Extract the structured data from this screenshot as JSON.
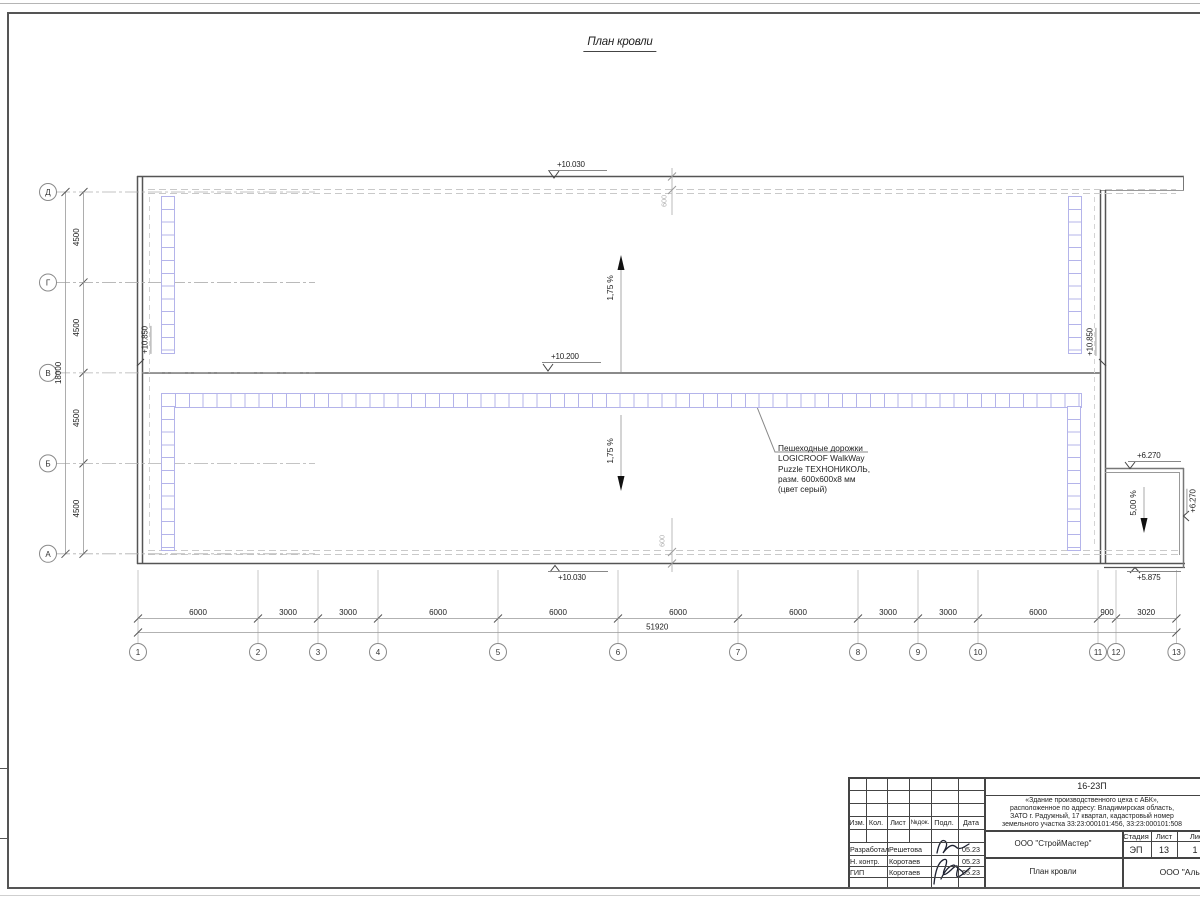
{
  "sheet": {
    "title": "План кровли"
  },
  "grid": {
    "cols": [
      "1",
      "2",
      "3",
      "4",
      "5",
      "6",
      "7",
      "8",
      "9",
      "10",
      "11",
      "12",
      "13"
    ],
    "col_spans": [
      "6000",
      "3000",
      "3000",
      "6000",
      "6000",
      "6000",
      "6000",
      "3000",
      "3000",
      "6000",
      "900",
      "3020"
    ],
    "col_total": "51920",
    "rows": [
      "Д",
      "Г",
      "В",
      "Б",
      "А"
    ],
    "row_spans": [
      "4500",
      "4500",
      "4500",
      "4500"
    ],
    "row_total": "18000"
  },
  "marks": {
    "eave_top": "+10.030",
    "ridge": "+10.200",
    "eave_bottom": "+10.030",
    "parapet_left": "+10.850",
    "parapet_right": "+10.850",
    "annex_top": "+6.270",
    "annex_right": "+6.270",
    "annex_bottom": "+5.875",
    "parapet_offset_top": "600",
    "parapet_offset_bottom": "600",
    "slope_up": "1,75 %",
    "slope_down": "1,75 %",
    "slope_annex": "5,00 %"
  },
  "note": {
    "l1": "Пешеходные дорожки",
    "l2": "LOGICROOF WalkWay",
    "l3": "Puzzle ТЕХНОНИКОЛЬ,",
    "l4": "разм. 600х600х8 мм",
    "l5": "(цвет серый)"
  },
  "stamp": {
    "doc_number": "16-23П",
    "address1": "«Здание производственного цеха с АБК»,",
    "address2": "расположенное по адресу: Владимирская область,",
    "address3": "ЗАТО г. Радужный, 17 квартал, кадастровый номер",
    "address4": "земельного участка 33:23:000101:456, 33:23:000101:508",
    "designer_org": "ООО \"СтройМастер\"",
    "client_org": "ООО \"Альянс\"",
    "sheet_name": "План кровли",
    "col_izm": "Изм.",
    "col_kol": "Кол.",
    "col_list": "Лист",
    "col_ndok": "№док.",
    "col_podp": "Подл.",
    "col_data": "Дата",
    "stage_label": "Стадия",
    "list_label": "Лист",
    "listov_label": "Листов",
    "stage": "ЭП",
    "list_no": "13",
    "listov": "1",
    "r1_role": "Разработал",
    "r1_name": "Решетова",
    "r1_date": "05.23",
    "r2_role": "Н. контр.",
    "r2_name": "Коротаев",
    "r2_date": "05.23",
    "r3_role": "ГИП",
    "r3_name": "Коротаев",
    "r3_date": "05.23"
  }
}
